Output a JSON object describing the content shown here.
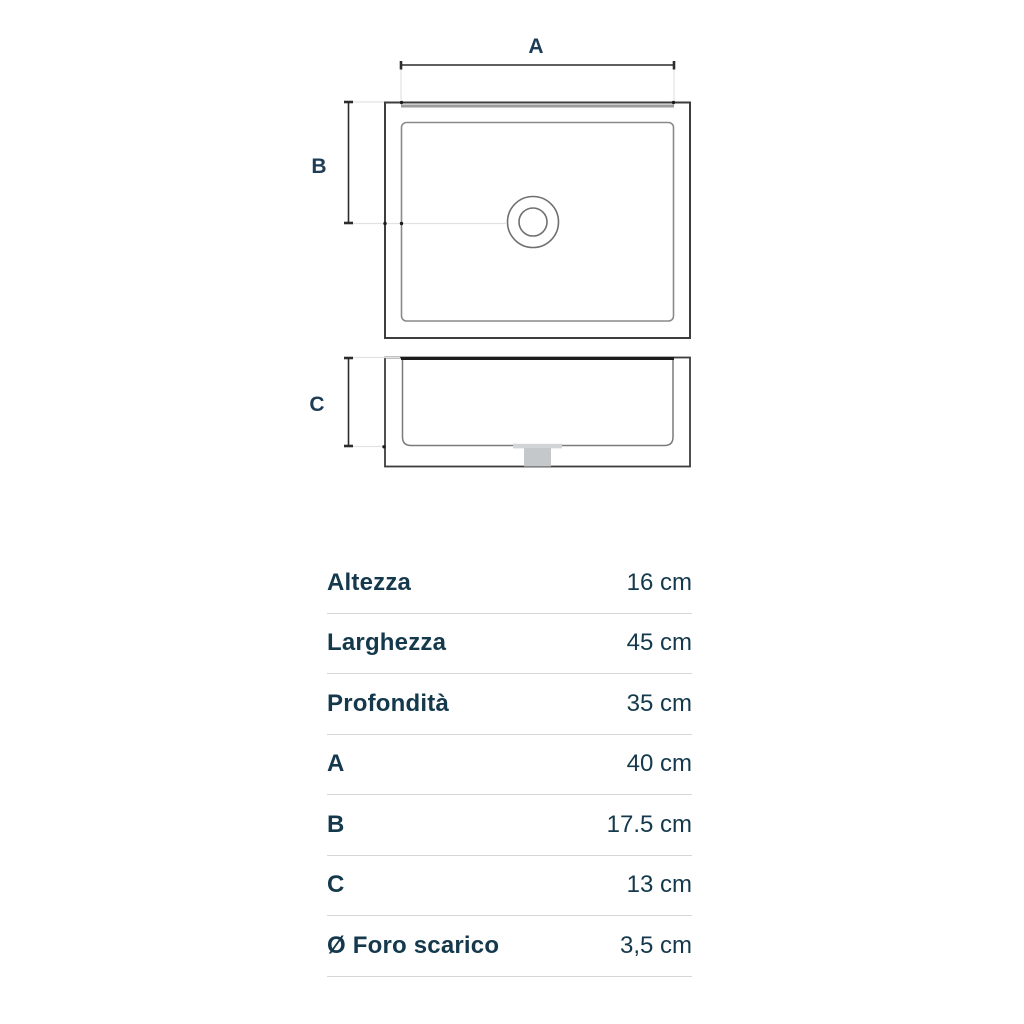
{
  "diagram": {
    "labels": {
      "a": "A",
      "b": "B",
      "c": "C"
    },
    "colors": {
      "dim_label": "#1e3c56",
      "dim_line": "#2c2c2c",
      "outline_dark": "#3d3d3d",
      "outline_mid": "#7a7a7a",
      "extension_light": "#e2e2e2",
      "rim_gray": "#9b9b9b",
      "drain_fill": "#c4c8cb",
      "flange_fill": "#d2d5d7"
    }
  },
  "table": {
    "rows": [
      {
        "label": "Altezza",
        "value": "16 cm"
      },
      {
        "label": "Larghezza",
        "value": "45 cm"
      },
      {
        "label": "Profondità",
        "value": "35 cm"
      },
      {
        "label": "A",
        "value": "40 cm"
      },
      {
        "label": "B",
        "value": "17.5 cm"
      },
      {
        "label": "C",
        "value": "13 cm"
      },
      {
        "label": "Ø Foro scarico",
        "value": "3,5 cm"
      }
    ],
    "text_color": "#14394c",
    "divider_color": "#d6d6d6"
  }
}
